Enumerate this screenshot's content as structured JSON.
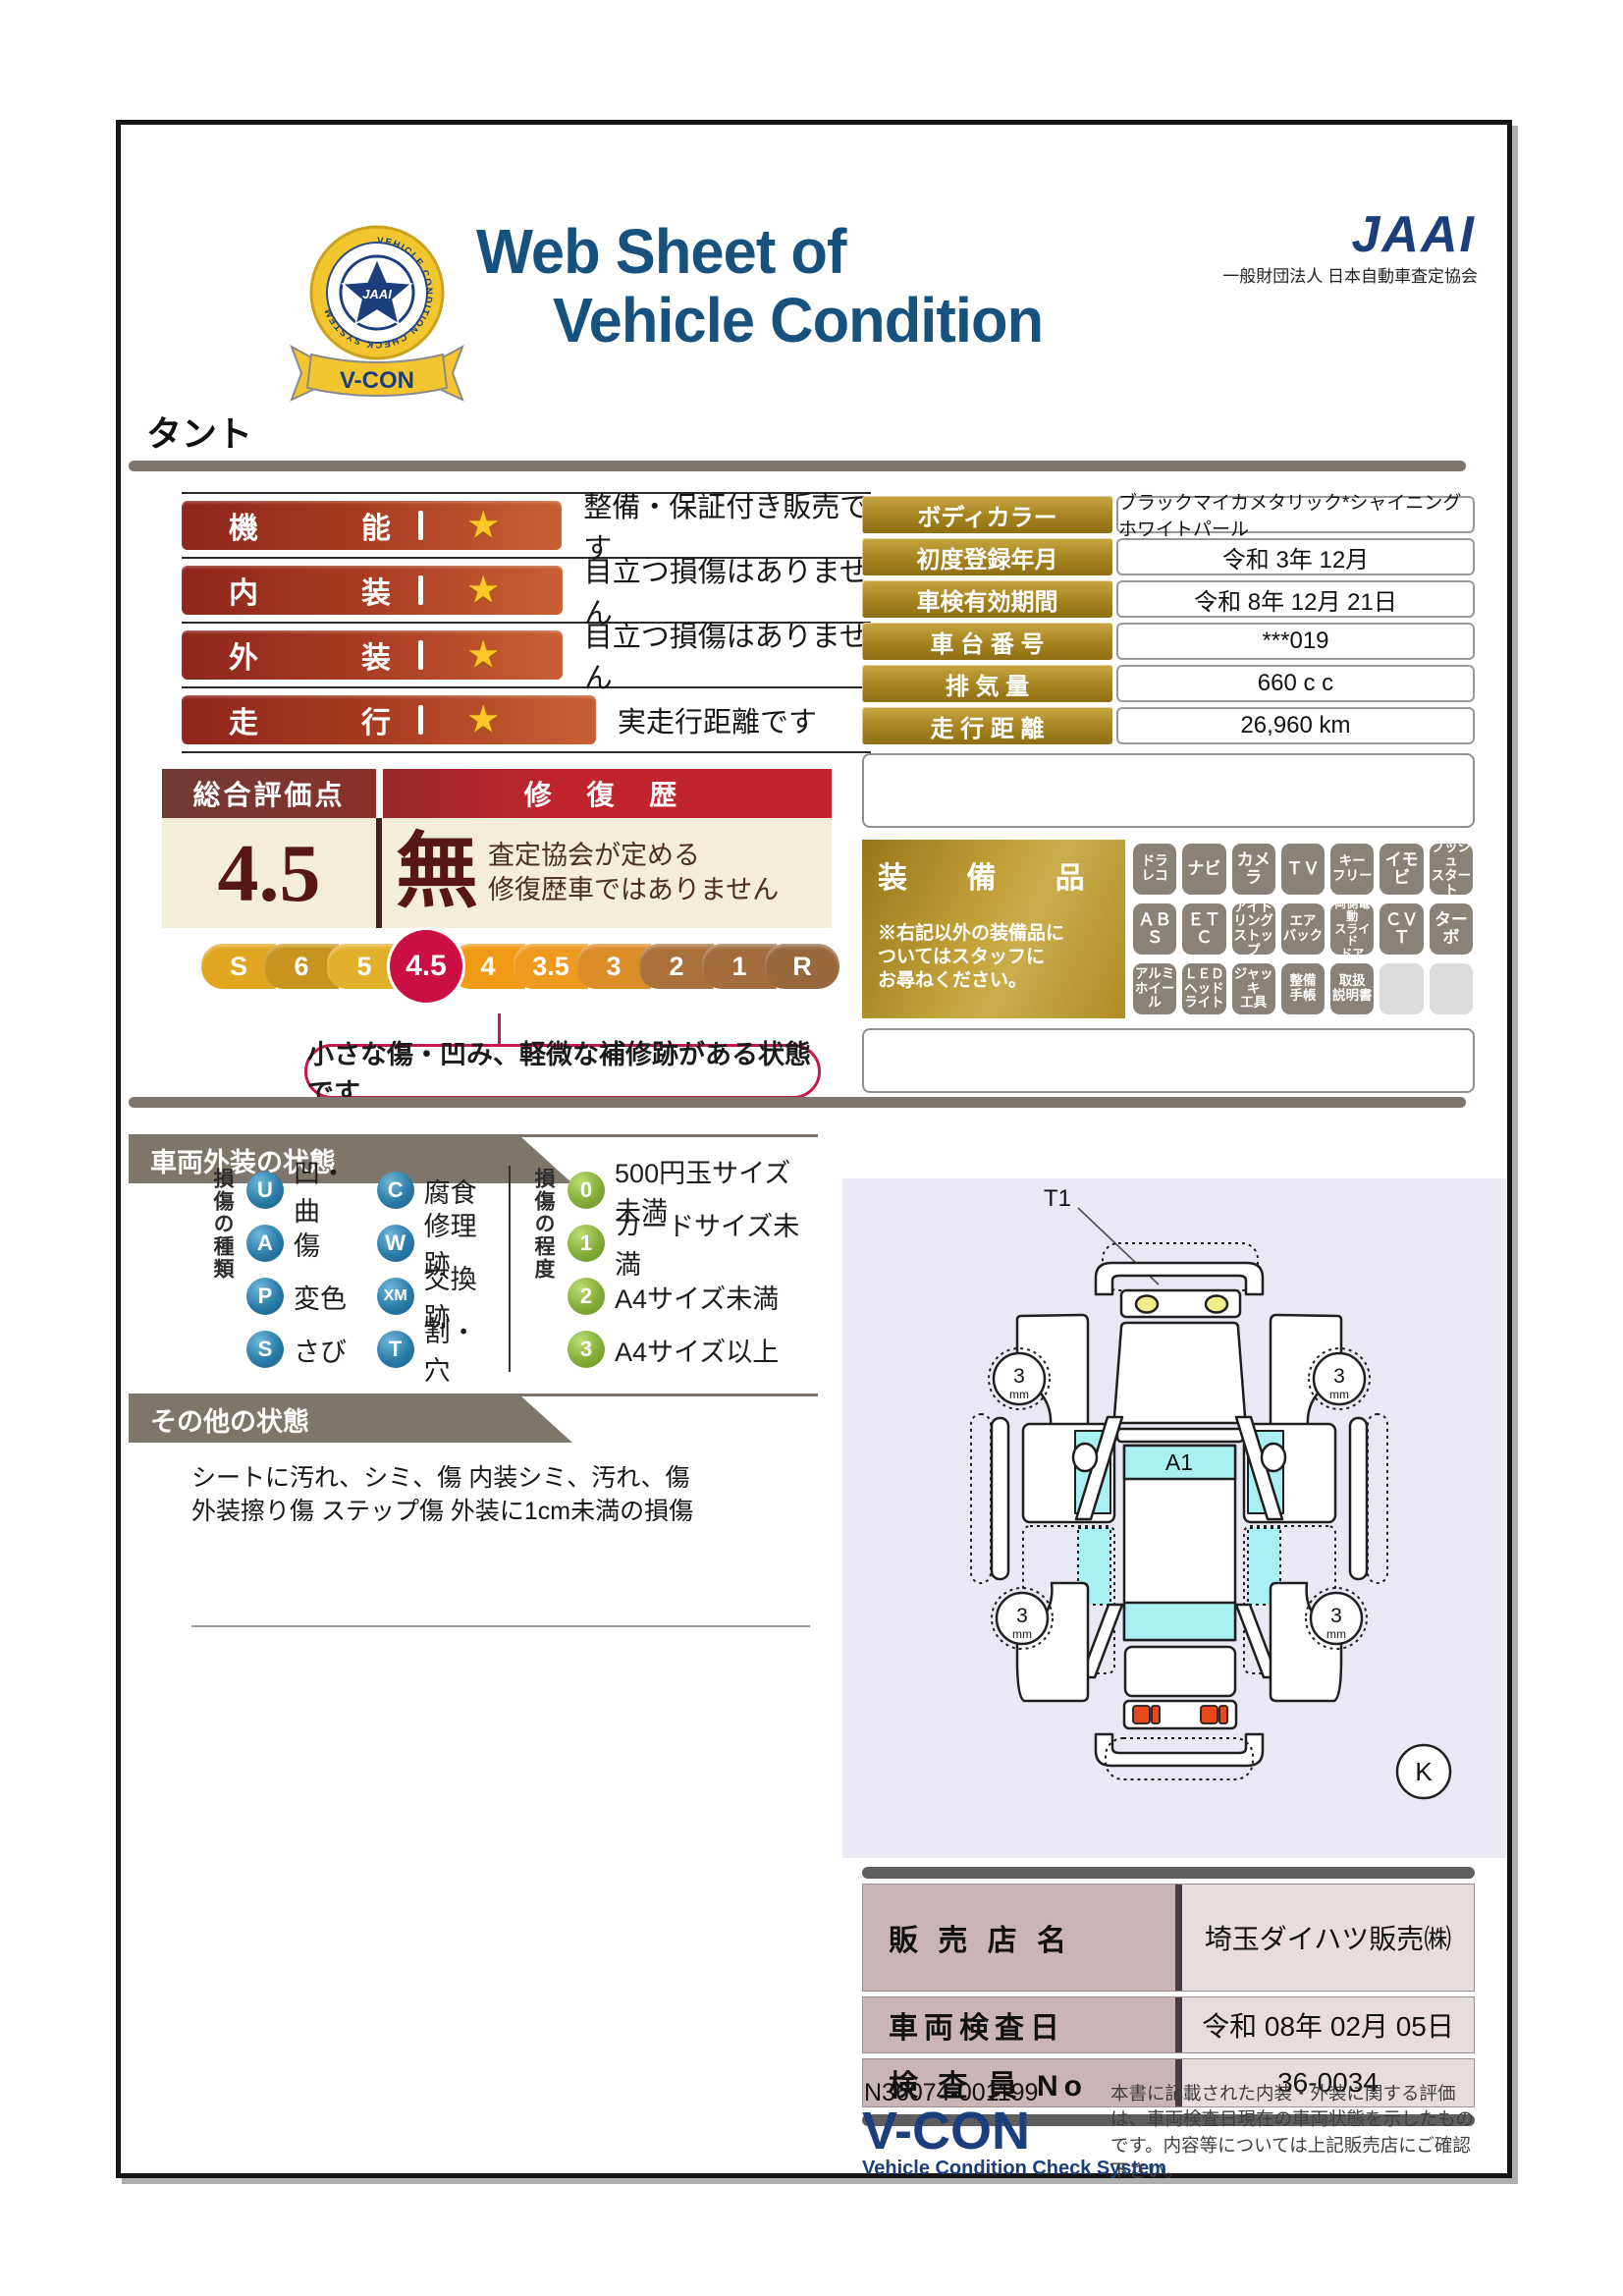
{
  "header": {
    "title_line1": "Web Sheet of",
    "title_line2": "Vehicle Condition",
    "org_logo": "JAAI",
    "org_name": "一般財団法人 日本自動車査定協会",
    "badge": {
      "ring_text": "VEHICLE CONDITION CHECK SYSTEM",
      "center": "JAAI",
      "ribbon": "V-CON"
    }
  },
  "model_name": "タント",
  "ratings": [
    {
      "label1": "機",
      "label2": "能",
      "desc": "整備・保証付き販売です"
    },
    {
      "label1": "内",
      "label2": "装",
      "desc": "目立つ損傷はありません"
    },
    {
      "label1": "外",
      "label2": "装",
      "desc": "目立つ損傷はありません"
    },
    {
      "label1": "走",
      "label2": "行",
      "desc": "実走行距離です"
    }
  ],
  "vehicle_info": [
    {
      "label": "ボディカラー",
      "value": "ブラックマイカメタリック*シャイニングホワイトパール"
    },
    {
      "label": "初度登録年月",
      "value": "令和 3年 12月"
    },
    {
      "label": "車検有効期間",
      "value": "令和 8年 12月 21日"
    },
    {
      "label": "車 台 番 号",
      "value": "***019"
    },
    {
      "label": "排  気  量",
      "value": "660 c c"
    },
    {
      "label": "走 行 距 離",
      "value": "26,960 km"
    }
  ],
  "evaluation": {
    "header_left": "総合評価点",
    "header_right": "修 復 歴",
    "score": "4.5",
    "repair": "無",
    "repair_note": "査定協会が定める\n修復歴車ではありません",
    "callout": "小さな傷・凹み、軽微な補修跡がある状態です",
    "scale": [
      {
        "label": "S",
        "color": "#E2A51F"
      },
      {
        "label": "6",
        "color": "#C8941F"
      },
      {
        "label": "5",
        "color": "#E3B02C"
      },
      {
        "label": "4.5",
        "color": "#CB0F45",
        "selected": true
      },
      {
        "label": "4",
        "color": "#F09A16"
      },
      {
        "label": "3.5",
        "color": "#EE9A1F"
      },
      {
        "label": "3",
        "color": "#DB8D28"
      },
      {
        "label": "2",
        "color": "#AA713B"
      },
      {
        "label": "1",
        "color": "#A26C3D"
      },
      {
        "label": "R",
        "color": "#97673E"
      }
    ]
  },
  "equipment": {
    "title": "装 備 品",
    "note": "※右記以外の装備品に\nついてはスタッフに\nお尋ねください。",
    "items": [
      {
        "label": "ドラ\nレコ"
      },
      {
        "label": "ナビ",
        "big": true
      },
      {
        "label": "カメラ",
        "big": true
      },
      {
        "label": "ＴＶ",
        "big": true
      },
      {
        "label": "キー\nフリー"
      },
      {
        "label": "イモビ",
        "big": true
      },
      {
        "label": "プッシュ\nスタート"
      },
      {
        "label": "ＡＢＳ",
        "big": true
      },
      {
        "label": "ＥＴＣ",
        "big": true
      },
      {
        "label": "アイド\nリング\nストップ"
      },
      {
        "label": "エア\nバック"
      },
      {
        "label": "両側電動\nスライド\nドア"
      },
      {
        "label": "ＣＶＴ",
        "big": true
      },
      {
        "label": "ターボ",
        "big": true
      },
      {
        "label": "アルミ\nホイール"
      },
      {
        "label": "ＬＥＤ\nヘッド\nライト"
      },
      {
        "label": "ジャッキ\n工具"
      },
      {
        "label": "整備\n手帳"
      },
      {
        "label": "取扱\n説明書"
      },
      {
        "label": "",
        "empty": true
      },
      {
        "label": "",
        "empty": true
      }
    ]
  },
  "exterior": {
    "header": "車両外装の状態",
    "type_label": "損傷の種類",
    "degree_label": "損傷の程度",
    "types": [
      {
        "code": "U",
        "label": "凹・曲"
      },
      {
        "code": "C",
        "label": "腐食"
      },
      {
        "code": "A",
        "label": "傷"
      },
      {
        "code": "W",
        "label": "修理跡"
      },
      {
        "code": "P",
        "label": "変色"
      },
      {
        "code": "XM",
        "label": "交換跡"
      },
      {
        "code": "S",
        "label": "さび"
      },
      {
        "code": "T",
        "label": "割・穴"
      }
    ],
    "degrees": [
      {
        "code": "0",
        "label": "500円玉サイズ未満"
      },
      {
        "code": "1",
        "label": "カードサイズ未満"
      },
      {
        "code": "2",
        "label": "A4サイズ未満"
      },
      {
        "code": "3",
        "label": "A4サイズ以上"
      }
    ]
  },
  "other": {
    "header": "その他の状態",
    "text": "シートに汚れ、シミ、傷 内装シミ、汚れ、傷\n外装擦り傷 ステップ傷 外装に1cm未満の損傷"
  },
  "diagram": {
    "t1": "T1",
    "a1": "A1",
    "k": "K",
    "tire": "3",
    "tire_unit": "mm"
  },
  "dealer": [
    {
      "label": "販 売 店 名",
      "value": "埼玉ダイハツ販売㈱"
    },
    {
      "label": "車両検査日",
      "value": "令和 08年 02月 05日"
    },
    {
      "label": "検 査 員 No",
      "value": "36-0034"
    }
  ],
  "footer": {
    "doc_no": "N36074-001199",
    "vcon": "V-CON",
    "vcon_sub": "Vehicle Condition Check System",
    "disclaimer": "本書に記載された内装・外装に関する評価は、車両検査日現在の車両状態を示したものです。内容等については上記販売店にご確認下さい。"
  },
  "colors": {
    "title_navy": "#17517E",
    "bar_taupe": "#7E756B",
    "accent_red": "#CB0F45",
    "gold": "#A5831F",
    "cream": "#F3EDDA",
    "glass_cyan": "#A8F0F2"
  }
}
